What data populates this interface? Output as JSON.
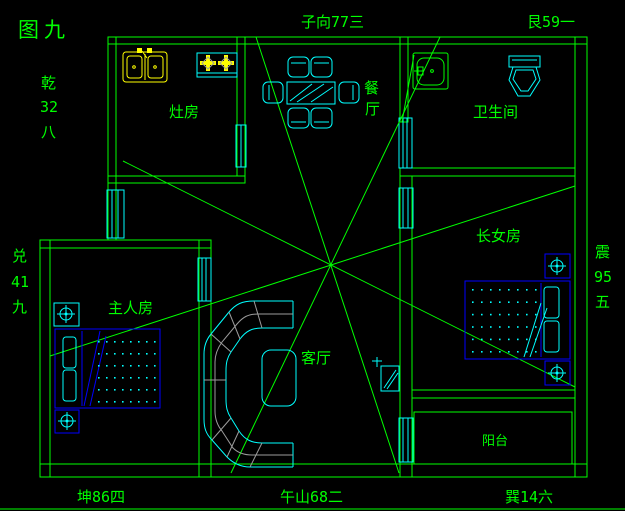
{
  "figure_label": "图九",
  "compass": {
    "top_center": "子向77三",
    "top_right": "艮59一",
    "left_upper": [
      "乾",
      "32",
      "八"
    ],
    "left_lower": [
      "兑",
      "41",
      "九"
    ],
    "right_middle": [
      "震",
      "95",
      "五"
    ],
    "bottom_left": "坤86四",
    "bottom_center": "午山68二",
    "bottom_right": "巽14六"
  },
  "rooms": {
    "kitchen": "灶房",
    "dining": [
      "餐",
      "厅"
    ],
    "bathroom": "卫生间",
    "eldest_daughter": "长女房",
    "master": "主人房",
    "living": "客厅",
    "balcony": "阳台"
  },
  "colors": {
    "background": "#000000",
    "wall_line": "#00ff00",
    "fixture_line": "#00ffff",
    "bed_frame": "#0000ff",
    "appliance": "#ffff00",
    "sofa_detail": "#9c9c9c"
  }
}
